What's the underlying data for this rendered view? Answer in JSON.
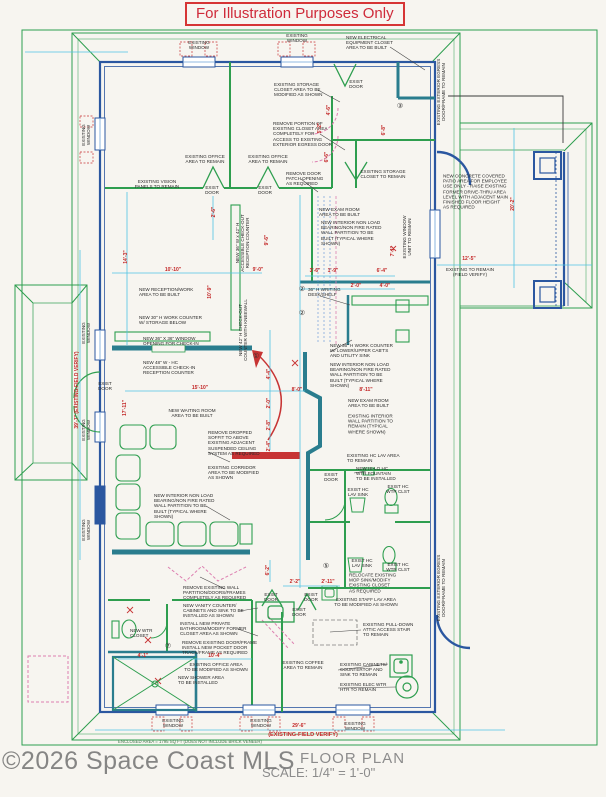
{
  "banner": {
    "text": "For Illustration Purposes Only"
  },
  "footer": {
    "enclosed_area": "ENCLOSED AREA = 1795 SQ FT (DOES NOT INCLUDE BRICK VENEER)",
    "drawing_title": "FLOOR PLAN",
    "scale": "SCALE: 1/4\" = 1'-0\"",
    "watermark": "©2026 Space Coast MLS"
  },
  "colors": {
    "existing_green": "#2e9e4f",
    "new_wall_teal": "#2a7d8e",
    "exterior_wall_blue": "#2b57a0",
    "dimension_cyan": "#4fc4e4",
    "annotation_red": "#c22525",
    "demolition_pink": "#dd7fb0",
    "banner_red": "#cf2b3a"
  },
  "labels": [
    {
      "t": "EXISTING\nWINDOW",
      "x": 199,
      "y": 45
    },
    {
      "t": "EXISTING\nWINDOW",
      "x": 297,
      "y": 38
    },
    {
      "t": "NEW ELECTRICAL\nEQUIPMENT CLOSET\nAREA TO BE BUILT",
      "x": 346,
      "y": 43,
      "a": "l"
    },
    {
      "t": "EXIST\nDOOR",
      "x": 356,
      "y": 84
    },
    {
      "t": "EXISTING STORAGE\nCLOSET AREA TO BE\nMODIFIED AS SHOWN",
      "x": 274,
      "y": 90,
      "a": "l"
    },
    {
      "t": "REMOVE PORTION OF\nEXISTING CLOSET AREA\nCOMPLETELY FOR\nACCESS TO EXISTING\nEXTERIOR EGRESS DOOR",
      "x": 273,
      "y": 134,
      "a": "l"
    },
    {
      "t": "EXISTING EXTERIOR EGRESS\nDOOR/FRAME TO REMAIN",
      "x": 441,
      "y": 92,
      "r": -90
    },
    {
      "t": "EXISTING STORAGE\nCLOSET TO REMAIN",
      "x": 383,
      "y": 174
    },
    {
      "t": "EXISTING OFFICE\nAREA TO REMAIN",
      "x": 205,
      "y": 159
    },
    {
      "t": "EXISTING OFFICE\nAREA TO REMAIN",
      "x": 268,
      "y": 159
    },
    {
      "t": "EXISTING VISION\nPANELS TO REMAIN",
      "x": 157,
      "y": 184
    },
    {
      "t": "EXIST\nDOOR",
      "x": 212,
      "y": 190
    },
    {
      "t": "EXIST\nDOOR",
      "x": 265,
      "y": 190
    },
    {
      "t": "REMOVE DOOR\nPATCH OPENING\nAS REQUIRED",
      "x": 286,
      "y": 179,
      "a": "l"
    },
    {
      "t": "NEW RECEPTION/WORK\nAREA TO BE BUILT",
      "x": 139,
      "y": 292,
      "a": "l"
    },
    {
      "t": "NEW 30\" H WORK COUNTER\nW/ STORAGE BELOW",
      "x": 139,
      "y": 320,
      "a": "l"
    },
    {
      "t": "NEW 36\" W x 42\" H\nACCESSIBLE CHECK-OUT\nRECEPTION COUNTER",
      "x": 243,
      "y": 243,
      "r": -90
    },
    {
      "t": "NEW 42\" H CHECK-OUT\nCOUNTER WITH KNEEWALL",
      "x": 243,
      "y": 330,
      "r": -90
    },
    {
      "t": "NEW 36\" X 36\" WINDOW\nOPENING FOR CHECK-IN",
      "x": 143,
      "y": 341,
      "a": "l"
    },
    {
      "t": "NEW 48\" W - HC\nACCESSIBLE CHECK-IN\nRECEPTION COUNTER",
      "x": 143,
      "y": 368,
      "a": "l"
    },
    {
      "t": "NEW WAITING ROOM\nAREA TO BE BUILT",
      "x": 192,
      "y": 413
    },
    {
      "t": "EXIST\nDOOR",
      "x": 105,
      "y": 386
    },
    {
      "t": "REMOVE DROPPED\nSOFFIT TO ABOVE\nEXISTING ADJACENT\nSUSPENDED CEILING\nSYSTEM AS REQUIRED",
      "x": 208,
      "y": 443,
      "a": "l"
    },
    {
      "t": "EXISTING CORRIDOR\nAREA TO BE MODIFIED\nAS SHOWN",
      "x": 208,
      "y": 473,
      "a": "l"
    },
    {
      "t": "NEW INTERIOR NON LOAD\nBEARING/NON FIRE RATED\nWALL PARTITION TO BE\nBUILT (TYPICAL WHERE\nSHOWN)",
      "x": 154,
      "y": 506,
      "a": "l"
    },
    {
      "t": "REMOVE EXISTING WALL\nPARTITION/DOORS/FRAMES\nCOMPLETELY AS REQUIRED",
      "x": 183,
      "y": 593,
      "a": "l"
    },
    {
      "t": "NEW VANITY COUNTER/\nCABINETS AND SINK TO BE\nINSTALLED AS SHOWN",
      "x": 183,
      "y": 611,
      "a": "l"
    },
    {
      "t": "INSTALL NEW PRIVATE\nBATHROOM/MODIFY FORMER\nCLOSET AREA AS SHOWN",
      "x": 180,
      "y": 629,
      "a": "l"
    },
    {
      "t": "REMOVE EXISTING DOOR/FRAME\nINSTALL NEW POCKET DOOR\nTRACK/FRAME AS REQUIRED",
      "x": 182,
      "y": 648,
      "a": "l"
    },
    {
      "t": "NEW WTR\nCLOSET",
      "x": 130,
      "y": 633,
      "a": "l"
    },
    {
      "t": "EXISTING OFFICE AREA\nTO BE MODIFIED AS SHOWN",
      "x": 216,
      "y": 667
    },
    {
      "t": "NEW SHOWER AREA\nTO BE INSTALLED",
      "x": 178,
      "y": 680,
      "a": "l"
    },
    {
      "t": "EXISTING\nWINDOW",
      "x": 173,
      "y": 723
    },
    {
      "t": "EXISTING\nWINDOW",
      "x": 261,
      "y": 723
    },
    {
      "t": "EXISTING\nWINDOW",
      "x": 355,
      "y": 726
    },
    {
      "t": "EXISTING\nWINDOW",
      "x": 86,
      "y": 135,
      "r": -90
    },
    {
      "t": "EXISTING\nWINDOW",
      "x": 86,
      "y": 333,
      "r": -90
    },
    {
      "t": "EXISTING\nWINDOW",
      "x": 86,
      "y": 430,
      "r": -90
    },
    {
      "t": "EXISTING\nWINDOW",
      "x": 86,
      "y": 530,
      "r": -90
    },
    {
      "t": "NEW CONCRETE COVERED\nPATIO AREA FOR EMPLOYEE\nUSE ONLY - RAISE EXISTING\nFORMER DRIVE-THRU AREA\nLEVEL WITH ADJACENT MAIN\nFINISHED FLOOR HEIGHT\nAS REQUIRED",
      "x": 443,
      "y": 192,
      "a": "l"
    },
    {
      "t": "EXISTING TO REMAIN\n(FIELD VERIFY)",
      "x": 470,
      "y": 272
    },
    {
      "t": "NEW EXAM ROOM\nAREA TO BE BUILT",
      "x": 319,
      "y": 212,
      "a": "l"
    },
    {
      "t": "NEW INTERIOR NON LOAD\nBEARING/NON FIRE RATED\nWALL PARTITION TO BE\nBUILT (TYPICAL WHERE\nSHOWN)",
      "x": 321,
      "y": 233,
      "a": "l"
    },
    {
      "t": "EXISTING WINDOW\nUNIT TO REMAIN",
      "x": 407,
      "y": 237,
      "r": -90
    },
    {
      "t": "36\" H WRITING\nDESK/SHELF",
      "x": 308,
      "y": 292,
      "a": "l"
    },
    {
      "t": "NEW 36\" H WORK COUNTER\nW/ LOWER/UPPER CAB'TS\nAND UTILITY SINK",
      "x": 330,
      "y": 351,
      "a": "l"
    },
    {
      "t": "NEW INTERIOR NON LOAD\nBEARING/NON FIRE RATED\nWALL PARTITION TO BE\nBUILT (TYPICAL WHERE\nSHOWN)",
      "x": 330,
      "y": 375,
      "a": "l"
    },
    {
      "t": "NEW EXAM ROOM\nAREA TO BE BUILT",
      "x": 348,
      "y": 403,
      "a": "l"
    },
    {
      "t": "EXISTING INTERIOR\nWALL PARTITION TO\nREMAIN (TYPICAL\nWHERE SHOWN)",
      "x": 348,
      "y": 424,
      "a": "l"
    },
    {
      "t": "EXISTING HC LAV AREA\nTO REMAIN",
      "x": 347,
      "y": 458,
      "a": "l"
    },
    {
      "t": "NEW HI-LO HC\nWTR FOUNTAIN\nTO BE INSTALLED",
      "x": 356,
      "y": 474,
      "a": "l"
    },
    {
      "t": "EXIST\nDOOR",
      "x": 331,
      "y": 477
    },
    {
      "t": "EXIST HC\nLAV SINK",
      "x": 358,
      "y": 492
    },
    {
      "t": "EXIST HC\nWTR CLST",
      "x": 398,
      "y": 489
    },
    {
      "t": "EXIST HC\nLAV SINK",
      "x": 362,
      "y": 563
    },
    {
      "t": "EXIST HC\nWTR CLST",
      "x": 398,
      "y": 567
    },
    {
      "t": "RELOCATE EXISTING\nMOP SINK/MODIFY\nEXISTING CLOSET\nAS REQUIRED",
      "x": 349,
      "y": 583,
      "a": "l"
    },
    {
      "t": "EXISTING STAFF LAV AREA\nTO BE MODIFIED AS SHOWN",
      "x": 366,
      "y": 602
    },
    {
      "t": "EXIST\nDOOR",
      "x": 271,
      "y": 597
    },
    {
      "t": "EXIST\nDOOR",
      "x": 311,
      "y": 597
    },
    {
      "t": "EXIST\nDOOR",
      "x": 299,
      "y": 612
    },
    {
      "t": "EXISTING PULL-DOWN\nATTIC ACCESS STAIR\nTO REMAIN",
      "x": 363,
      "y": 630,
      "a": "l"
    },
    {
      "t": "EXISTING COFFEE\nAREA TO REMAIN",
      "x": 303,
      "y": 665
    },
    {
      "t": "EXISTING CABINETS/\nCOUNTERTOP AND\nSINK TO REMAIN",
      "x": 340,
      "y": 670,
      "a": "l"
    },
    {
      "t": "EXISTING ELEC WTR\nHTR TO REMAIN",
      "x": 340,
      "y": 687,
      "a": "l"
    },
    {
      "t": "EXISTING EXTERIOR EGRESS\nDOOR/FRAME TO REMAIN",
      "x": 441,
      "y": 588,
      "r": -90
    }
  ],
  "dimensions": [
    {
      "t": "2'-6\"",
      "x": 215,
      "y": 212,
      "r": -90
    },
    {
      "t": "14'-3\"",
      "x": 127,
      "y": 257,
      "r": -90
    },
    {
      "t": "10'-10\"",
      "x": 173,
      "y": 271
    },
    {
      "t": "10'-9\"",
      "x": 211,
      "y": 292,
      "r": -90
    },
    {
      "t": "9'-0\"",
      "x": 258,
      "y": 271
    },
    {
      "t": "9'-6\"",
      "x": 268,
      "y": 240,
      "r": -90
    },
    {
      "t": "4'-6\"",
      "x": 330,
      "y": 110,
      "r": -90
    },
    {
      "t": "5'-2\"",
      "x": 321,
      "y": 128,
      "r": -90
    },
    {
      "t": "6'-6\"",
      "x": 328,
      "y": 157,
      "r": -90
    },
    {
      "t": "6'-8\"",
      "x": 385,
      "y": 130,
      "r": -90
    },
    {
      "t": "3'-6\"",
      "x": 315,
      "y": 272
    },
    {
      "t": "1'-9\"",
      "x": 333,
      "y": 272
    },
    {
      "t": "6'-4\"",
      "x": 382,
      "y": 272
    },
    {
      "t": "2'-0\"",
      "x": 356,
      "y": 287
    },
    {
      "t": "4'-0\"",
      "x": 385,
      "y": 287
    },
    {
      "t": "7'-1\"",
      "x": 394,
      "y": 251,
      "r": -90
    },
    {
      "t": "20'-2\"",
      "x": 514,
      "y": 204,
      "r": -90
    },
    {
      "t": "12'-5\"",
      "x": 469,
      "y": 260
    },
    {
      "t": "15'-10\"",
      "x": 200,
      "y": 389
    },
    {
      "t": "17'-11\"",
      "x": 126,
      "y": 408,
      "r": -90
    },
    {
      "t": "8'-0\"",
      "x": 297,
      "y": 391
    },
    {
      "t": "8'-11\"",
      "x": 366,
      "y": 391
    },
    {
      "t": "4'-4\"",
      "x": 270,
      "y": 374,
      "r": -90
    },
    {
      "t": "2'-0\"",
      "x": 270,
      "y": 403,
      "r": -90
    },
    {
      "t": "2'-8\"",
      "x": 270,
      "y": 425,
      "r": -90
    },
    {
      "t": "2'-4\"",
      "x": 270,
      "y": 446,
      "r": -90
    },
    {
      "t": "6'-2\"",
      "x": 269,
      "y": 570,
      "r": -90
    },
    {
      "t": "2'-2\"",
      "x": 295,
      "y": 583
    },
    {
      "t": "2'-11\"",
      "x": 328,
      "y": 583
    },
    {
      "t": "4'-1\"",
      "x": 143,
      "y": 657
    },
    {
      "t": "10'-4\"",
      "x": 215,
      "y": 657
    },
    {
      "t": "29'-6\"",
      "x": 299,
      "y": 727
    },
    {
      "t": "(EXISTING-FIELD VERIFY)",
      "x": 303,
      "y": 735,
      "s": 5.6
    },
    {
      "t": "39'-7\" (EXISTING-FIELD VERIFY)",
      "x": 78,
      "y": 390,
      "r": -90,
      "s": 5
    }
  ],
  "keynotes": [
    {
      "t": "①",
      "x": 256,
      "y": 357
    },
    {
      "t": "②",
      "x": 302,
      "y": 290
    },
    {
      "t": "②",
      "x": 302,
      "y": 314
    },
    {
      "t": "③",
      "x": 400,
      "y": 107
    },
    {
      "t": "⑤",
      "x": 326,
      "y": 567
    },
    {
      "t": "⑦",
      "x": 168,
      "y": 647
    }
  ]
}
